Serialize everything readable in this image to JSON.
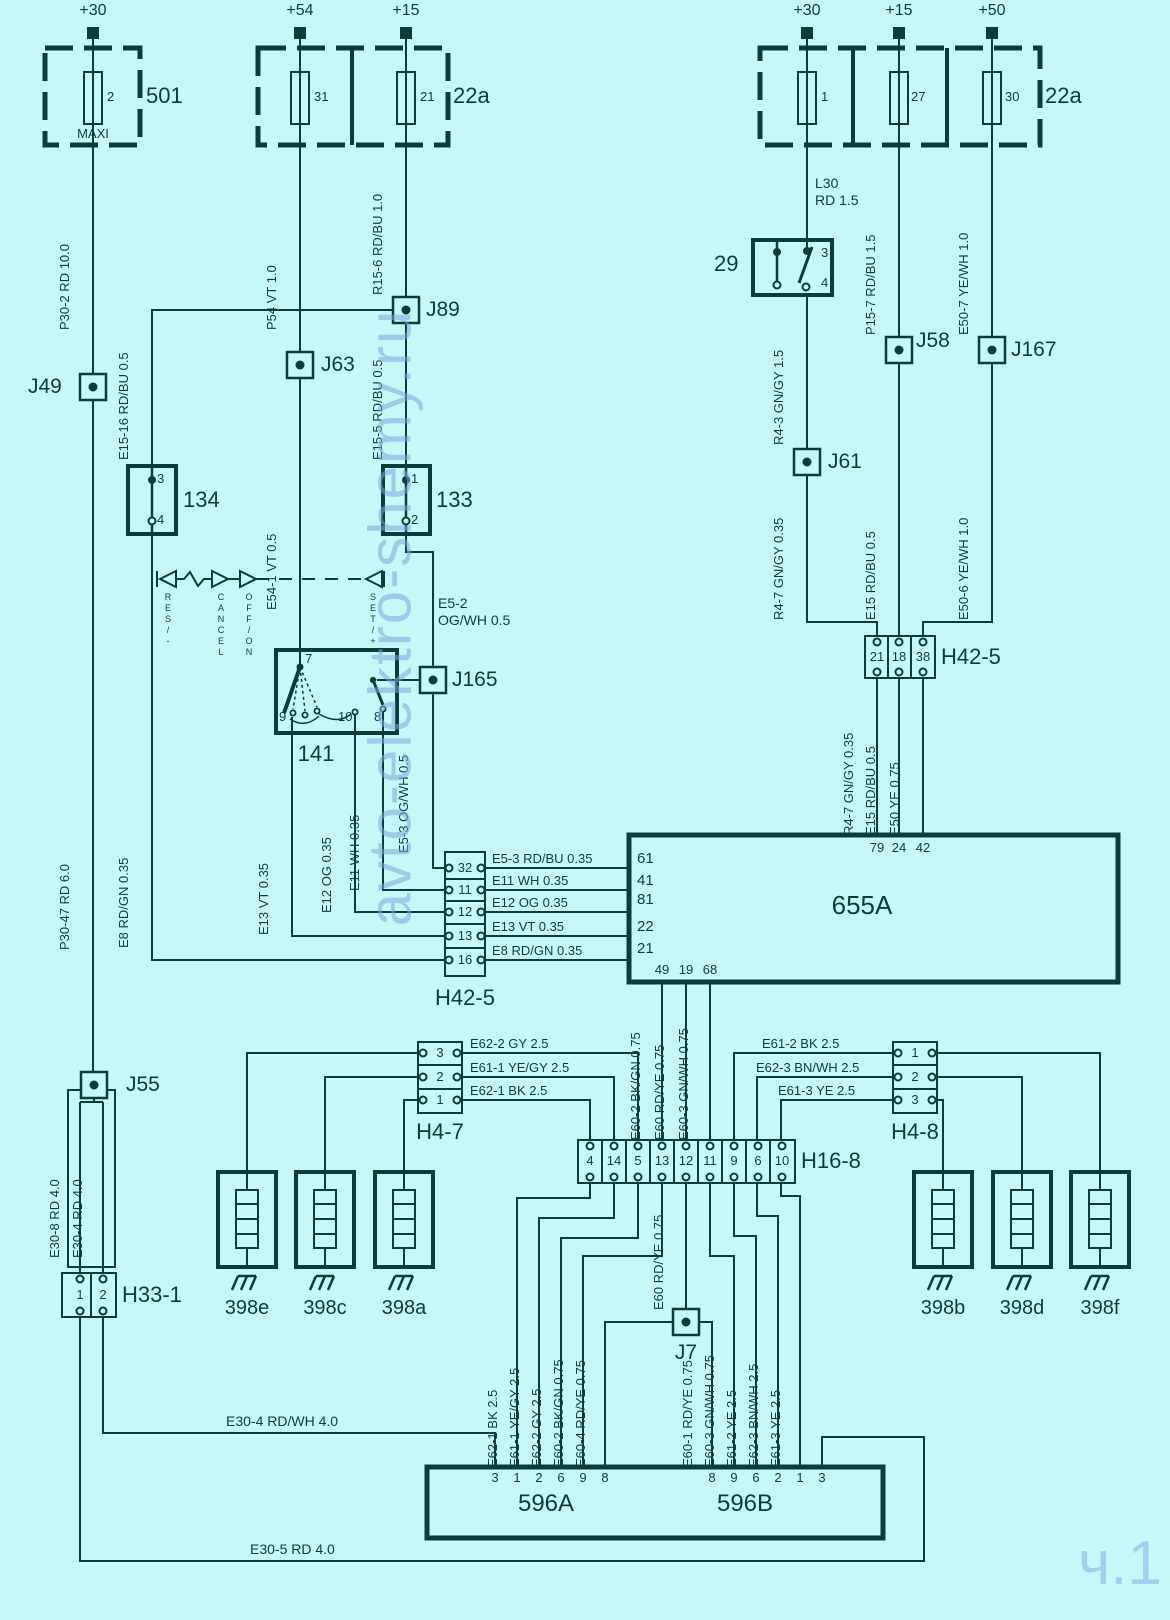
{
  "diagram": {
    "watermark_site": "avto-elektro-shemy.ru",
    "watermark_part": "ч.1",
    "supplies": [
      "+30",
      "+54",
      "+15",
      "+30",
      "+15",
      "+50"
    ],
    "fuse_boxes": {
      "b501": {
        "id": "501",
        "fuse": "2",
        "size": "MAXI"
      },
      "b22a_left": {
        "id": "22a",
        "fuses": [
          "31",
          "21"
        ]
      },
      "b22a_right": {
        "id": "22a",
        "fuses": [
          "1",
          "27",
          "30"
        ]
      }
    },
    "junctions": {
      "j49": "J49",
      "j63": "J63",
      "j89": "J89",
      "j165": "J165",
      "j61": "J61",
      "j58": "J58",
      "j167": "J167",
      "j55": "J55",
      "j7": "J7"
    },
    "switches": {
      "s29": {
        "id": "29",
        "pins": [
          "3",
          "4"
        ]
      },
      "s134": {
        "id": "134",
        "pins": [
          "3",
          "4"
        ]
      },
      "s133": {
        "id": "133",
        "pins": [
          "1",
          "2"
        ]
      },
      "s141": {
        "id": "141",
        "pins": [
          "7",
          "9",
          "10",
          "8"
        ],
        "positions": [
          "RES/-",
          "CANCEL",
          "OFF/ON",
          "SET/+"
        ]
      }
    },
    "ecu": {
      "id": "655A",
      "top_pins": [
        "79",
        "24",
        "42"
      ],
      "left_pins": [
        "61",
        "41",
        "81",
        "22",
        "21"
      ],
      "bottom_pins": [
        "49",
        "19",
        "68"
      ]
    },
    "connectors": {
      "h42_5_left": {
        "id": "H42-5",
        "pins": [
          "32",
          "11",
          "12",
          "13",
          "16"
        ]
      },
      "h42_5_right": {
        "id": "H42-5",
        "pins": [
          "21",
          "18",
          "38"
        ]
      },
      "h4_7": {
        "id": "H4-7",
        "pins": [
          "3",
          "2",
          "1"
        ]
      },
      "h4_8": {
        "id": "H4-8",
        "pins": [
          "1",
          "2",
          "3"
        ]
      },
      "h16_8": {
        "id": "H16-8",
        "pins": [
          "4",
          "14",
          "5",
          "13",
          "12",
          "11",
          "9",
          "6",
          "10"
        ]
      },
      "h33_1": {
        "id": "H33-1",
        "pins": [
          "1",
          "2"
        ]
      }
    },
    "module": {
      "a": "596A",
      "b": "596B",
      "a_pins": [
        "3",
        "1",
        "2",
        "6",
        "9",
        "8"
      ],
      "b_pins": [
        "8",
        "9",
        "6",
        "2",
        "1",
        "3"
      ]
    },
    "resistors": [
      "398e",
      "398c",
      "398a",
      "398b",
      "398d",
      "398f"
    ],
    "wires": {
      "p30_2": "P30-2  RD  10.0",
      "p54": "P54  VT  1.0",
      "r15_6": "R15-6  RD/BU  1.0",
      "p30_47": "P30-47  RD  6.0",
      "e15_16": "E15-16  RD/BU  0.5",
      "e15_5": "E15-5  RD/BU  0.5",
      "e54_1": "E54-1  VT  0.5",
      "e5_2_name": "E5-2",
      "e5_2_spec": "OG/WH  0.5",
      "e5_3": "E5-3  OG/WH  0.5",
      "e8": "E8  RD/GN  0.35",
      "e13": "E13  VT  0.35",
      "e12": "E12  OG  0.35",
      "e11": "E11  WH  0.35",
      "l30_name": "L30",
      "l30_spec": "RD 1.5",
      "r4_3": "R4-3  GN/GY  1.5",
      "r4_7": "R4-7  GN/GY  0.35",
      "p15_7": "P15-7  RD/BU  1.5",
      "e15": "E15  RD/BU  0.5",
      "e50_7": "E50-7  YE/WH  1.0",
      "e50_6": "E50-6  YE/WH  1.0",
      "e50": "E50  YE  0.75",
      "rows_655a": [
        "E5-3   RD/BU   0.35",
        "E11   WH   0.35",
        "E12   OG   0.35",
        "E13   VT   0.35",
        "E8   RD/GN   0.35"
      ],
      "cols_655a": [
        "E60-2  BK/GN  0.75",
        "E60  RD/YE  0.75",
        "E60-3  GN/WH  0.75"
      ],
      "h47_rows": [
        "E62-2   GY   2.5",
        "E61-1   YE/GY  2.5",
        "E62-1   BK   2.5"
      ],
      "h48_rows": [
        "E61-2   BK   2.5",
        "E62-3  BN/WH  2.5",
        "E61-3   YE   2.5"
      ],
      "e60_mid": "E60  RD/YE  0.75",
      "cols_596a": [
        "E62-1  BK  2.5",
        "E61-1 YE/GY 2.5",
        "E62-2  GY  2.5",
        "E60-2  BK/GN 0.75",
        "E60-4  RD/YE 0.75"
      ],
      "cols_596b": [
        "E60-1  RD/YE 0.75",
        "E60-3  GN/WH  0.75",
        "E61-2  YE  2.5",
        "E62-3  BN/WH  2.5",
        "E61-3  YE  2.5"
      ],
      "e30_8": "E30-8  RD  4.0",
      "e30_4_inner": "E30-4  RD  4.0",
      "e30_4": "E30-4   RD/WH   4.0",
      "e30_5": "E30-5   RD   4.0"
    }
  }
}
